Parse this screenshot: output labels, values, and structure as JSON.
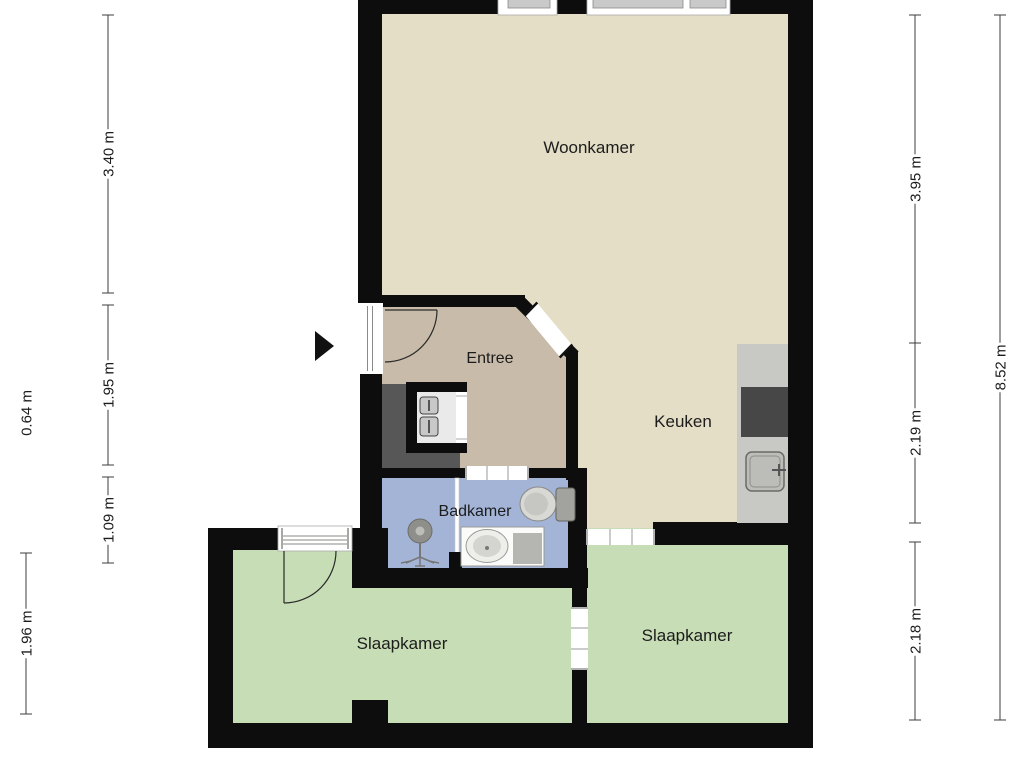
{
  "title": "Apartment floor plan",
  "colors": {
    "background": "#ffffff",
    "wall": "#0d0d0d",
    "living_floor": "#e4dec6",
    "entree_floor": "#c9bbaa",
    "bathroom_floor": "#a3b4d6",
    "bedroom_floor": "#c7ddb5",
    "shaft": "#575757",
    "closet_interior": "#eaeaea",
    "meter": "#c8c8c8",
    "counter": "#c8c8c4",
    "stove": "#474747",
    "sink_gray": "#bcbcb8",
    "fixture_light": "#d8d8d4",
    "fixture_gray": "#a2a29e",
    "basin_white": "#fbfbf9",
    "basin_gray": "#b5b5b1",
    "shower_head": "#8e8e8a",
    "window_glass": "#c9c9c9",
    "frame_line": "#8a8a86",
    "door_tick": "#999999",
    "dim_line": "#3c3c3c",
    "text": "#1c1c1c"
  },
  "rooms": [
    {
      "name": "woonkamer",
      "label": "Woonkamer"
    },
    {
      "name": "keuken",
      "label": "Keuken"
    },
    {
      "name": "entree",
      "label": "Entree"
    },
    {
      "name": "badkamer",
      "label": "Badkamer"
    },
    {
      "name": "slaapkamer-left",
      "label": "Slaapkamer"
    },
    {
      "name": "slaapkamer-right",
      "label": "Slaapkamer"
    }
  ],
  "dimensions": [
    {
      "label": "3.40 m",
      "x": 108,
      "y1": 15,
      "y2": 293
    },
    {
      "label": "1.95 m",
      "x": 108,
      "y1": 305,
      "y2": 465
    },
    {
      "label": "1.09 m",
      "x": 108,
      "y1": 477,
      "y2": 563
    },
    {
      "label": "0.64 m",
      "x": 26,
      "y1": null,
      "y2": null,
      "center": 413,
      "line": false
    },
    {
      "label": "1.96 m",
      "x": 26,
      "y1": 553,
      "y2": 714
    },
    {
      "label": "3.95 m",
      "x": 915,
      "y1": 15,
      "y2": 343
    },
    {
      "label": "2.19 m",
      "x": 915,
      "y1": 343,
      "y2": 523
    },
    {
      "label": "2.18 m",
      "x": 915,
      "y1": 542,
      "y2": 720
    },
    {
      "label": "8.52 m",
      "x": 1000,
      "y1": 15,
      "y2": 720
    }
  ],
  "fixtures": [
    {
      "name": "entrance-arrow"
    },
    {
      "name": "front-door"
    },
    {
      "name": "utility-meters-icon"
    },
    {
      "name": "shower-icon"
    },
    {
      "name": "toilet-icon"
    },
    {
      "name": "washbasin-icon"
    },
    {
      "name": "glass-partition"
    },
    {
      "name": "kitchen-counter"
    },
    {
      "name": "cooktop-icon"
    },
    {
      "name": "kitchen-sink-icon"
    }
  ]
}
